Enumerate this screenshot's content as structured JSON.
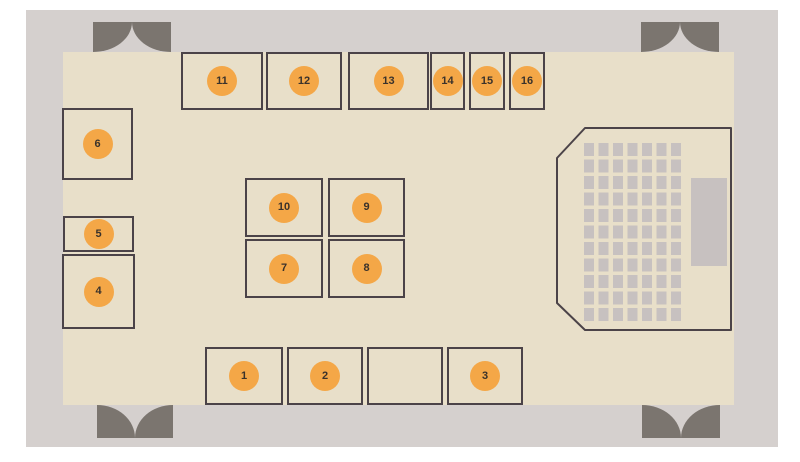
{
  "diagram": {
    "title": "",
    "type": "floor-plan",
    "colors": {
      "page_bg": "#ffffff",
      "outer_wall": "#d5d0ce",
      "floor": "#e8dfc9",
      "door": "#7b756f",
      "line": "#4b4348",
      "booth_fill": "#e8dfc9",
      "marker_fill": "#f4a747",
      "marker_text": "#3a322b",
      "seat_fill": "#c7c1c0",
      "screen_fill": "#c7c1c0"
    },
    "outer_wall": {
      "x": 26,
      "y": 10,
      "w": 752,
      "h": 437
    },
    "floor": {
      "x": 63,
      "y": 52,
      "w": 671,
      "h": 353
    },
    "doors": [
      {
        "id": "door-top-left",
        "x": 93,
        "y": 22,
        "w": 78,
        "h": 30,
        "swing": "down"
      },
      {
        "id": "door-top-right",
        "x": 641,
        "y": 22,
        "w": 78,
        "h": 30,
        "swing": "down"
      },
      {
        "id": "door-bottom-left",
        "x": 97,
        "y": 405,
        "w": 76,
        "h": 33,
        "swing": "up"
      },
      {
        "id": "door-bottom-right",
        "x": 642,
        "y": 405,
        "w": 78,
        "h": 33,
        "swing": "up"
      }
    ],
    "booths": [
      {
        "label": "1",
        "x": 205,
        "y": 347,
        "w": 78,
        "h": 58
      },
      {
        "label": "2",
        "x": 287,
        "y": 347,
        "w": 76,
        "h": 58
      },
      {
        "label": "",
        "x": 367,
        "y": 347,
        "w": 76,
        "h": 58
      },
      {
        "label": "3",
        "x": 447,
        "y": 347,
        "w": 76,
        "h": 58
      },
      {
        "label": "4",
        "x": 62,
        "y": 254,
        "w": 73,
        "h": 75
      },
      {
        "label": "5",
        "x": 63,
        "y": 216,
        "w": 71,
        "h": 36
      },
      {
        "label": "6",
        "x": 62,
        "y": 108,
        "w": 71,
        "h": 72
      },
      {
        "label": "7",
        "x": 245,
        "y": 239,
        "w": 78,
        "h": 59
      },
      {
        "label": "8",
        "x": 328,
        "y": 239,
        "w": 77,
        "h": 59
      },
      {
        "label": "9",
        "x": 328,
        "y": 178,
        "w": 77,
        "h": 59
      },
      {
        "label": "10",
        "x": 245,
        "y": 178,
        "w": 78,
        "h": 59
      },
      {
        "label": "11",
        "x": 181,
        "y": 52,
        "w": 82,
        "h": 58
      },
      {
        "label": "12",
        "x": 266,
        "y": 52,
        "w": 76,
        "h": 58
      },
      {
        "label": "13",
        "x": 348,
        "y": 52,
        "w": 81,
        "h": 58
      },
      {
        "label": "14",
        "x": 430,
        "y": 52,
        "w": 35,
        "h": 58
      },
      {
        "label": "15",
        "x": 469,
        "y": 52,
        "w": 36,
        "h": 58
      },
      {
        "label": "16",
        "x": 509,
        "y": 52,
        "w": 36,
        "h": 58
      }
    ],
    "seating_area": {
      "polygon": [
        [
          585,
          128
        ],
        [
          731,
          128
        ],
        [
          731,
          330
        ],
        [
          585,
          330
        ],
        [
          557,
          303
        ],
        [
          557,
          158
        ]
      ],
      "seat_grid": {
        "rows": 11,
        "cols": 7,
        "x": 584,
        "y": 143,
        "seat_w": 10,
        "seat_h": 13,
        "pitch_x": 14.5,
        "pitch_y": 16.5
      },
      "screen": {
        "x": 691,
        "y": 178,
        "w": 36,
        "h": 88
      }
    }
  }
}
